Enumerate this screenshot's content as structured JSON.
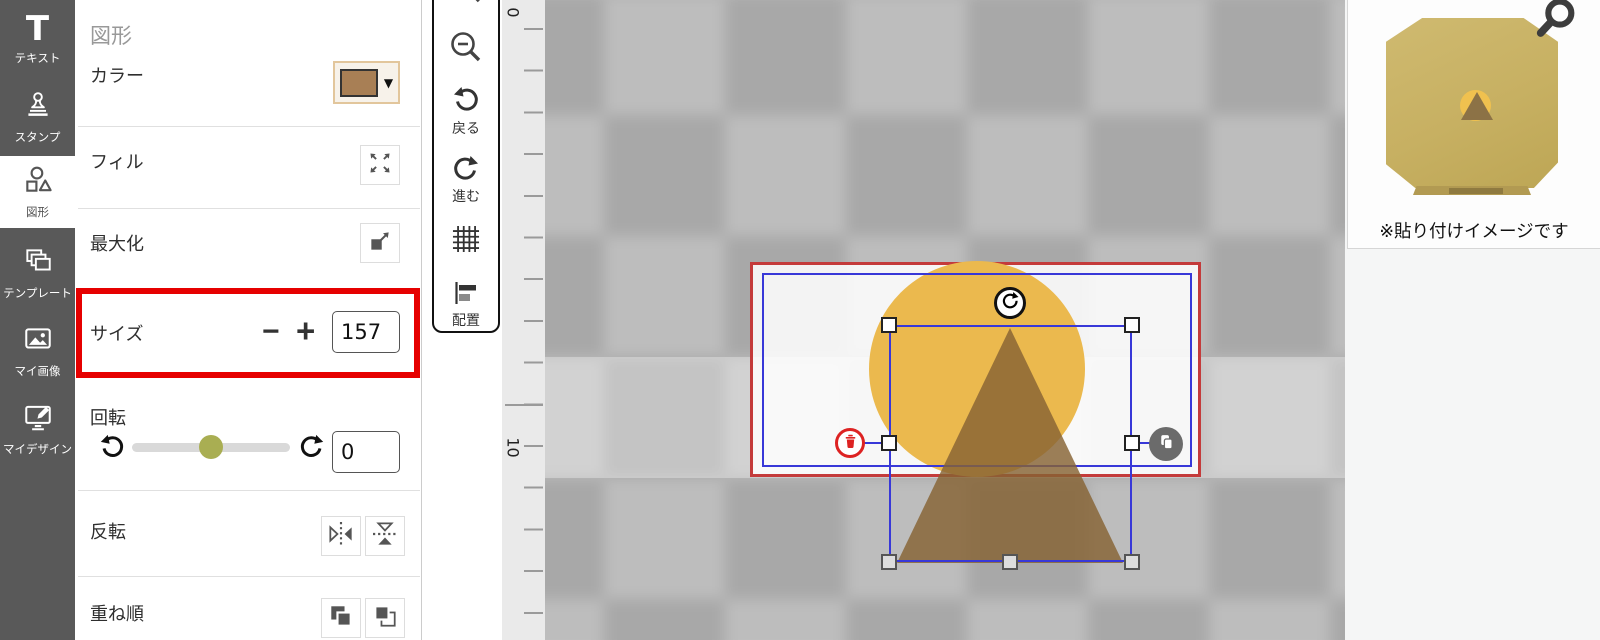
{
  "sidebar": {
    "items": [
      {
        "id": "text",
        "label": "テキスト",
        "active": false
      },
      {
        "id": "stamp",
        "label": "スタンプ",
        "active": false
      },
      {
        "id": "shape",
        "label": "図形",
        "active": true
      },
      {
        "id": "template",
        "label": "テンプレート",
        "active": false
      },
      {
        "id": "my-images",
        "label": "マイ画像",
        "active": false
      },
      {
        "id": "my-designs",
        "label": "マイデザイン",
        "active": false
      }
    ]
  },
  "panel": {
    "title": "図形",
    "color_label": "カラー",
    "fill_label": "フィル",
    "maximize_label": "最大化",
    "size": {
      "label": "サイズ",
      "minus": "−",
      "plus": "+",
      "value": "157",
      "highlighted": true
    },
    "rotation": {
      "label": "回転",
      "value": "0"
    },
    "flip_label": "反転",
    "order_label": "重ね順",
    "caret": "▼"
  },
  "toolbar": {
    "undo_label": "戻る",
    "redo_label": "進む",
    "align_label": "配置"
  },
  "ruler": {
    "label_top": "0",
    "label_major": "10"
  },
  "preview": {
    "caption": "※貼り付けイメージです"
  },
  "colors": {
    "highlight_red": "#e60000",
    "artboard_border_red": "#c43b3b",
    "selection_blue": "#3838d8",
    "shape_circle_yellow": "#ebb94e",
    "shape_triangle_brown": "rgba(134,99,51,0.82)",
    "swatch_brown": "#a87f55",
    "slider_knob_olive": "#a9ae52",
    "sidebar_gray": "#595959",
    "checker_dark": "#a8a8a8",
    "checker_light": "#bdbdbd"
  }
}
